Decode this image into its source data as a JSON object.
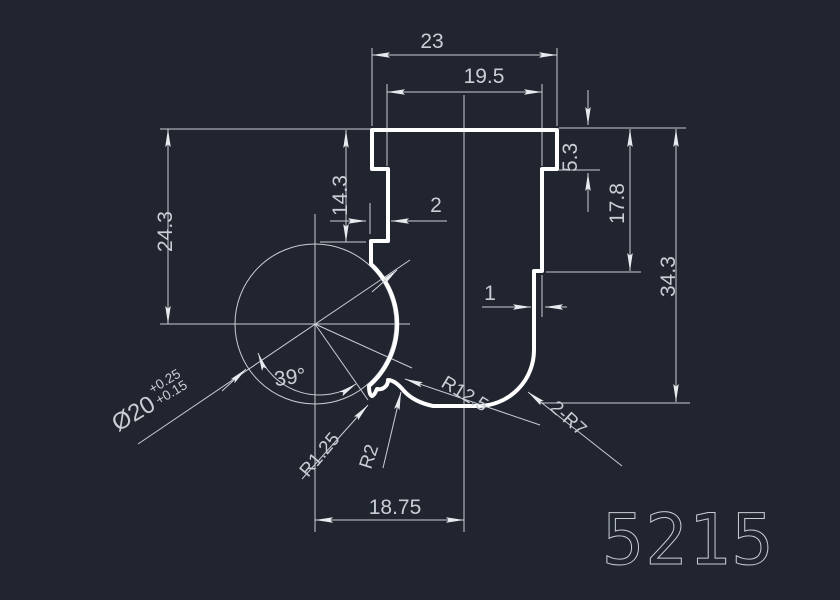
{
  "canvas": {
    "background": "#212530",
    "line_color": "#c9ced5",
    "profile_color": "#ffffff"
  },
  "part_number": "5215",
  "dims": {
    "width_top": "23",
    "width_inner": "19.5",
    "height_step_right": "5.3",
    "height_right_upper": "17.8",
    "height_total": "34.3",
    "height_left": "24.3",
    "height_left_upper": "14.3",
    "channel_depth": "2",
    "step_right": "1",
    "angle": "39°",
    "bottom_width": "18.75",
    "diameter": "Ø20",
    "diameter_tol_upper": "+0.25",
    "diameter_tol_lower": "+0.15",
    "radius_notch": "R1.25",
    "radius_bump": "R2",
    "radius_bottom": "R12.5",
    "radius_corners": "2-R7"
  }
}
